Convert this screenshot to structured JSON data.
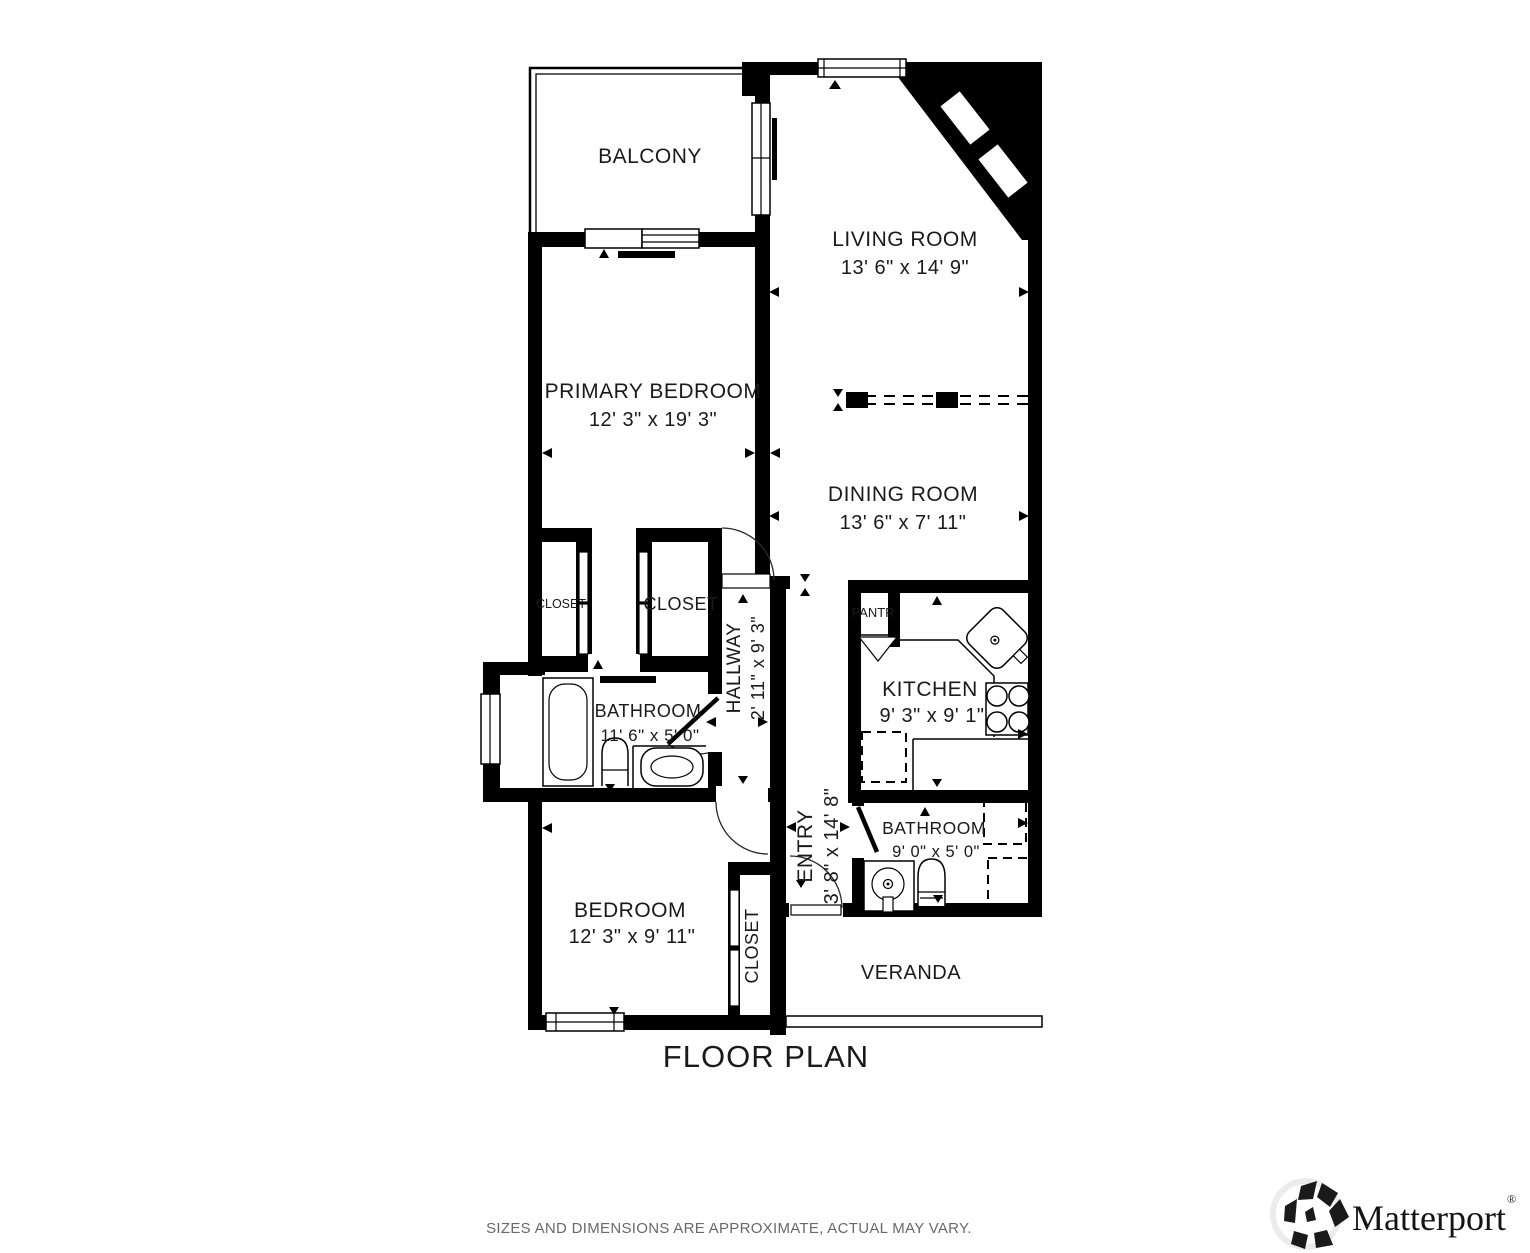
{
  "title": "FLOOR PLAN",
  "disclaimer": "SIZES AND DIMENSIONS ARE APPROXIMATE, ACTUAL MAY VARY.",
  "brand": {
    "name": "Matterport",
    "registered": "®"
  },
  "colors": {
    "wall": "#000000",
    "background": "#ffffff",
    "text": "#1a1a1a",
    "muted": "#696969"
  },
  "rooms": [
    {
      "id": "balcony",
      "name": "BALCONY",
      "dims": ""
    },
    {
      "id": "living-room",
      "name": "LIVING ROOM",
      "dims": "13' 6\" x 14' 9\""
    },
    {
      "id": "primary-bedroom",
      "name": "PRIMARY BEDROOM",
      "dims": "12' 3\" x 19' 3\""
    },
    {
      "id": "dining-room",
      "name": "DINING ROOM",
      "dims": "13' 6\" x 7' 11\""
    },
    {
      "id": "closet-left",
      "name": "CLOSET",
      "dims": ""
    },
    {
      "id": "closet-right",
      "name": "CLOSET",
      "dims": ""
    },
    {
      "id": "hallway",
      "name": "HALLWAY",
      "dims": "2' 11\" x 9' 3\""
    },
    {
      "id": "bathroom-main",
      "name": "BATHROOM",
      "dims": "11' 6\" x 5' 0\""
    },
    {
      "id": "pantry",
      "name": "PANTR",
      "dims": ""
    },
    {
      "id": "kitchen",
      "name": "KITCHEN",
      "dims": "9' 3\" x 9' 1\""
    },
    {
      "id": "entry",
      "name": "ENTRY",
      "dims": "3' 8\" x 14' 8\""
    },
    {
      "id": "bathroom-second",
      "name": "BATHROOM",
      "dims": "9' 0\" x 5' 0\""
    },
    {
      "id": "bedroom",
      "name": "BEDROOM",
      "dims": "12' 3\" x 9' 11\""
    },
    {
      "id": "closet-bedroom",
      "name": "CLOSET",
      "dims": ""
    },
    {
      "id": "veranda",
      "name": "VERANDA",
      "dims": ""
    }
  ]
}
